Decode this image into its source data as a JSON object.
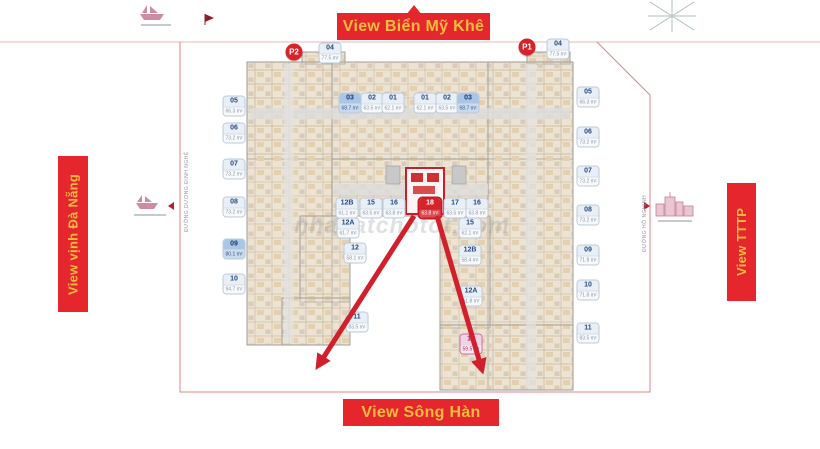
{
  "banners": {
    "top": "View Biển Mỹ Khê",
    "bottom": "View Sông Hàn",
    "left": "View vịnh Đà Nẵng",
    "right": "View TTTP"
  },
  "markers": {
    "p1": "P1",
    "p2": "P2"
  },
  "streets": {
    "left": "ĐƯỜNG DƯƠNG ĐÌNH NGHỆ",
    "right": "ĐƯỜNG HỒ NGHINH"
  },
  "watermark": "nhadatchotot.com",
  "colors": {
    "banner_red": "#e5262c",
    "banner_gold": "#f2bd3e",
    "arrow_red": "#d21f2c",
    "badge_blue_bg": "#a9c6e6",
    "unit_red": "#d8232b",
    "unit_pink": "#f0d4e6",
    "plan_beige": "#ece3d2"
  },
  "units": [
    {
      "label": "04",
      "area": "77.5 m²",
      "x": 330,
      "y": 53,
      "variant": "normal"
    },
    {
      "label": "04",
      "area": "77.5 m²",
      "x": 558,
      "y": 49,
      "variant": "normal"
    },
    {
      "label": "03",
      "area": "68.7 m²",
      "x": 350,
      "y": 103,
      "variant": "blue"
    },
    {
      "label": "02",
      "area": "63.5 m²",
      "x": 372,
      "y": 103,
      "variant": "normal"
    },
    {
      "label": "01",
      "area": "62.1 m²",
      "x": 393,
      "y": 103,
      "variant": "normal"
    },
    {
      "label": "01",
      "area": "62.1 m²",
      "x": 425,
      "y": 103,
      "variant": "normal"
    },
    {
      "label": "02",
      "area": "63.5 m²",
      "x": 447,
      "y": 103,
      "variant": "normal"
    },
    {
      "label": "03",
      "area": "68.7 m²",
      "x": 468,
      "y": 103,
      "variant": "blue"
    },
    {
      "label": "05",
      "area": "66.3 m²",
      "x": 234,
      "y": 106,
      "variant": "normal"
    },
    {
      "label": "06",
      "area": "73.2 m²",
      "x": 234,
      "y": 133,
      "variant": "normal"
    },
    {
      "label": "07",
      "area": "73.2 m²",
      "x": 234,
      "y": 169,
      "variant": "normal"
    },
    {
      "label": "08",
      "area": "73.2 m²",
      "x": 234,
      "y": 207,
      "variant": "normal"
    },
    {
      "label": "09",
      "area": "80.1 m²",
      "x": 234,
      "y": 249,
      "variant": "blue"
    },
    {
      "label": "10",
      "area": "94.7 m²",
      "x": 234,
      "y": 284,
      "variant": "normal"
    },
    {
      "label": "05",
      "area": "66.3 m²",
      "x": 588,
      "y": 97,
      "variant": "normal"
    },
    {
      "label": "06",
      "area": "73.2 m²",
      "x": 588,
      "y": 137,
      "variant": "normal"
    },
    {
      "label": "07",
      "area": "73.2 m²",
      "x": 588,
      "y": 176,
      "variant": "normal"
    },
    {
      "label": "08",
      "area": "73.2 m²",
      "x": 588,
      "y": 215,
      "variant": "normal"
    },
    {
      "label": "09",
      "area": "71.8 m²",
      "x": 588,
      "y": 255,
      "variant": "normal"
    },
    {
      "label": "10",
      "area": "71.8 m²",
      "x": 588,
      "y": 290,
      "variant": "normal"
    },
    {
      "label": "11",
      "area": "83.5 m²",
      "x": 588,
      "y": 333,
      "variant": "normal"
    },
    {
      "label": "12B",
      "area": "61.1 m²",
      "x": 347,
      "y": 208,
      "variant": "normal"
    },
    {
      "label": "15",
      "area": "63.5 m²",
      "x": 371,
      "y": 208,
      "variant": "normal"
    },
    {
      "label": "16",
      "area": "63.8 m²",
      "x": 394,
      "y": 208,
      "variant": "normal"
    },
    {
      "label": "18",
      "area": "63.8 m²",
      "x": 430,
      "y": 208,
      "variant": "red"
    },
    {
      "label": "17",
      "area": "63.5 m²",
      "x": 455,
      "y": 208,
      "variant": "normal"
    },
    {
      "label": "16",
      "area": "63.8 m²",
      "x": 477,
      "y": 208,
      "variant": "normal"
    },
    {
      "label": "12A",
      "area": "61.7 m²",
      "x": 348,
      "y": 228,
      "variant": "normal"
    },
    {
      "label": "12",
      "area": "58.1 m²",
      "x": 355,
      "y": 253,
      "variant": "normal"
    },
    {
      "label": "15",
      "area": "62.1 m²",
      "x": 470,
      "y": 228,
      "variant": "normal"
    },
    {
      "label": "12B",
      "area": "58.4 m²",
      "x": 470,
      "y": 255,
      "variant": "normal"
    },
    {
      "label": "12A",
      "area": "61.8 m²",
      "x": 471,
      "y": 296,
      "variant": "normal"
    },
    {
      "label": "11",
      "area": "83.5 m²",
      "x": 357,
      "y": 322,
      "variant": "normal"
    },
    {
      "label": "12",
      "area": "59.5 m²",
      "x": 471,
      "y": 344,
      "variant": "pink"
    }
  ]
}
